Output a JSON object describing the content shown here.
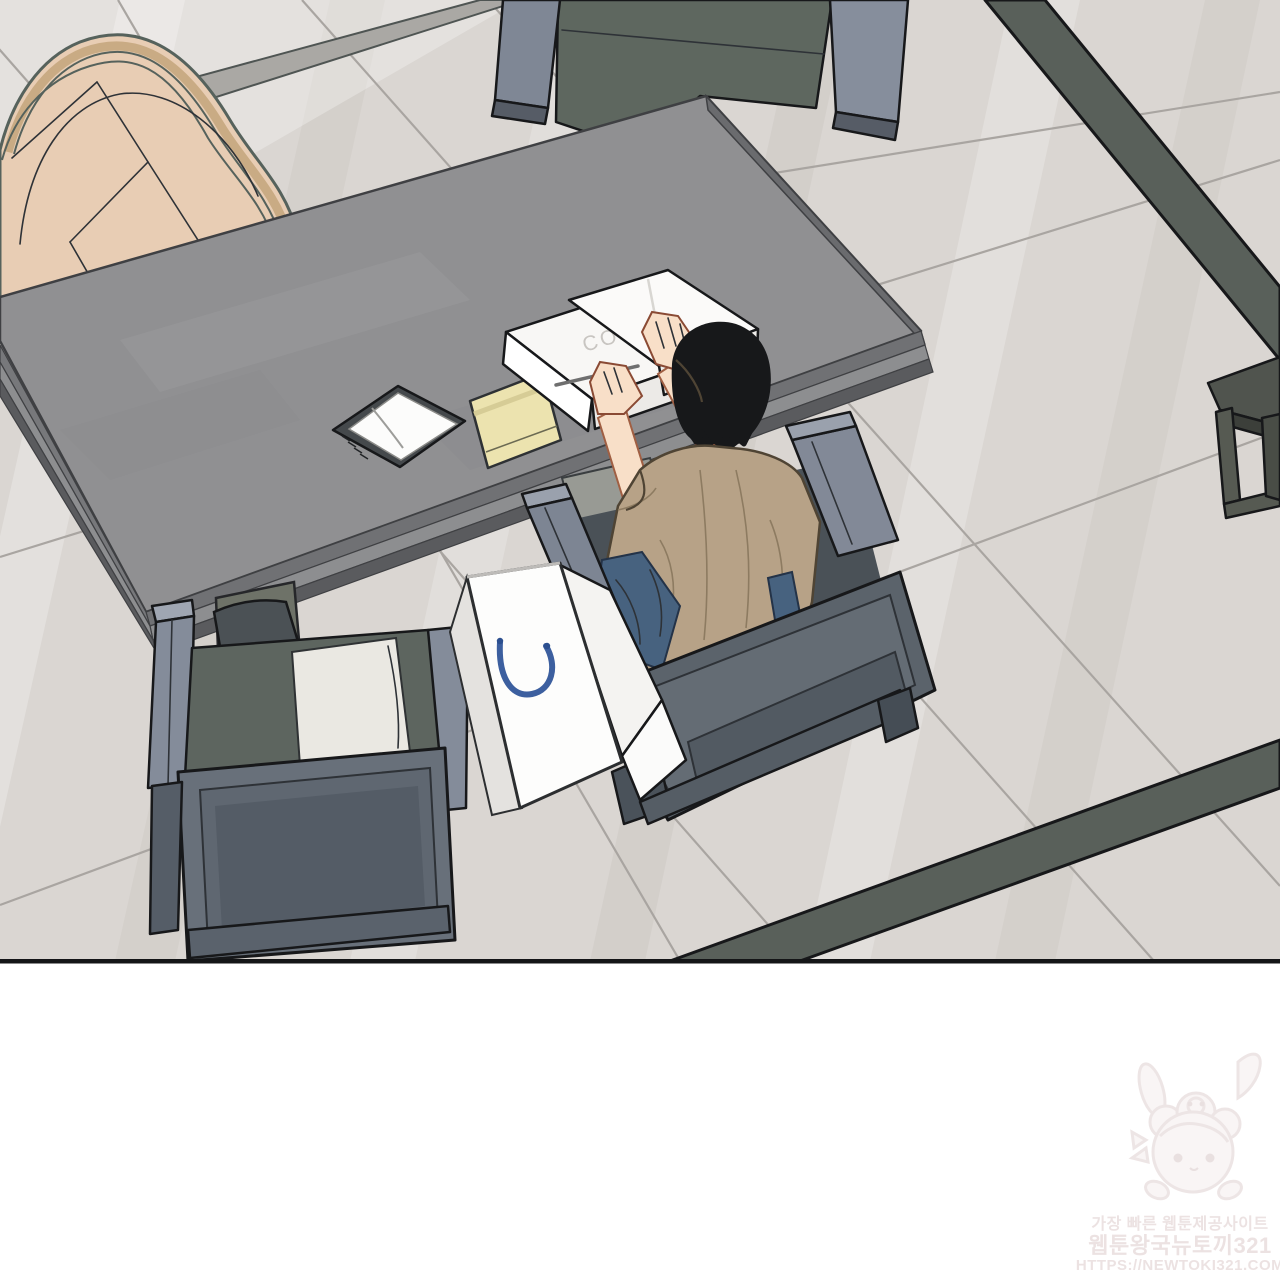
{
  "page": {
    "background_color": "#ffffff"
  },
  "panel": {
    "kind": "webtoon-comic-panel",
    "floor_color": "#dad6d2",
    "grout_color": "#a9a5a1",
    "rug_edge_color": "#59605a",
    "desk_color": "#909092",
    "tan_chair_color": "#e8cdb4",
    "armchair_body_color": "#5d655f",
    "armrest_color": "#848c9a",
    "cushion_color": "#eae8e2",
    "hair_color": "#17181a",
    "skin_color": "#f8dfc8",
    "shirt_color": "#b7a287",
    "jeans_color": "#47627f",
    "bag_color": "#fdfdfc",
    "bag_handle_color": "#3c5f9f",
    "notepad_color": "#ece3af",
    "border_color": "#141517"
  },
  "desk_items": {
    "box_label": "CO"
  },
  "watermark": {
    "line1": "가장 빠른 웹툰제공사이트",
    "line2": "웹툰왕국뉴토끼321",
    "line3": "HTTPS://NEWTOKI321.COM",
    "text_color": "#e9dede"
  }
}
